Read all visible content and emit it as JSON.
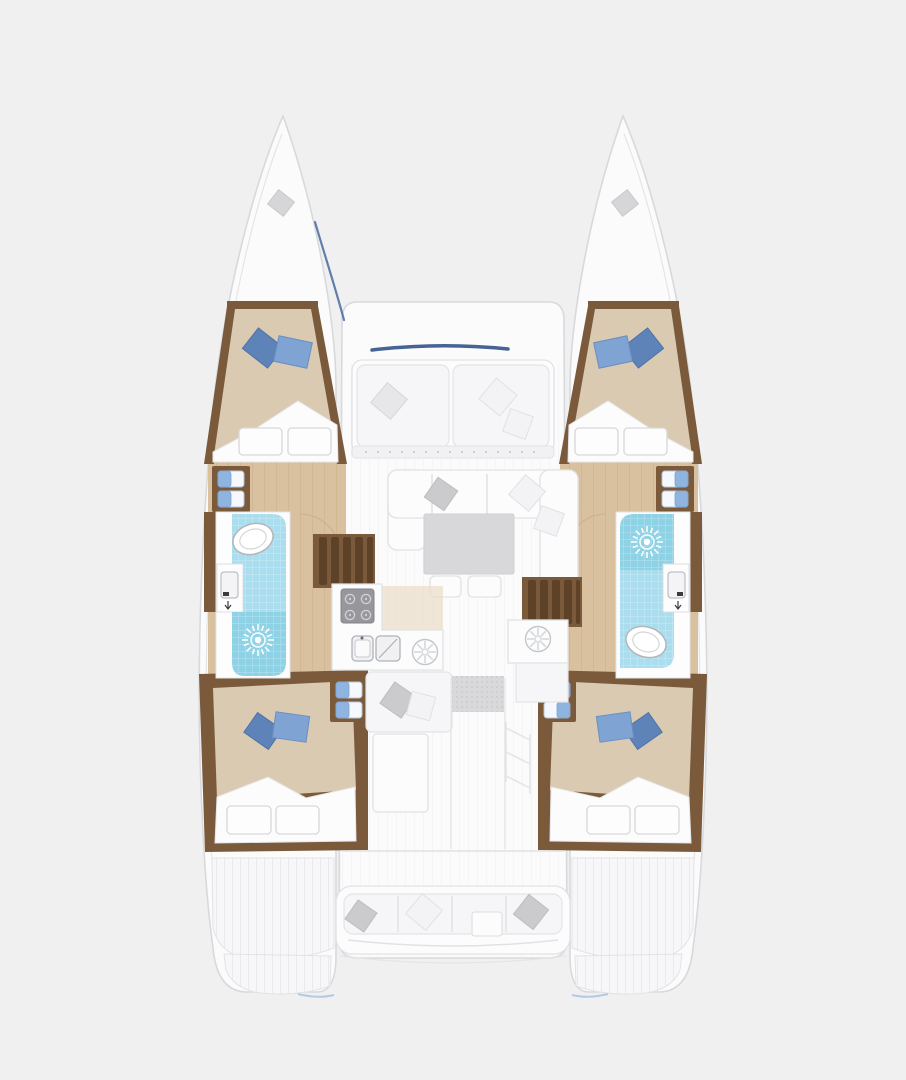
{
  "page": {
    "type": "catamaran-deck-floor-plan",
    "view": "top-down",
    "background": "#f0f0f1"
  },
  "palette": {
    "bg": "#f0f0f1",
    "hull": "#fbfbfc",
    "hullStroke": "#d7d9dc",
    "trim": "#7a5a3a",
    "trimDark": "#5d4227",
    "wood": "#d9c09f",
    "plankLine": "#c9ac89",
    "bedTan": "#d9cab1",
    "pillowBlue": "#5e83b8",
    "pillowBlueLight": "#7fa3d3",
    "headTile": "#aadeee",
    "showerBlue": "#8ed2e6",
    "stepBlue": "#8fb4e0",
    "furnGray": "#d8d8da",
    "windshieldNavy": "#35568a",
    "halyardBlue": "#49699f"
  },
  "vessel": {
    "hulls": 2,
    "cabins": [
      {
        "id": "port-forward-cabin",
        "berth": "double",
        "blue_pillows": 2,
        "foot_cushions": 2
      },
      {
        "id": "starboard-forward-cabin",
        "berth": "double",
        "blue_pillows": 2,
        "foot_cushions": 2
      },
      {
        "id": "port-aft-cabin",
        "berth": "double",
        "blue_pillows": 2,
        "foot_cushions": 2
      },
      {
        "id": "starboard-aft-cabin",
        "berth": "double",
        "blue_pillows": 2,
        "foot_cushions": 2
      }
    ],
    "heads": [
      {
        "id": "port-head",
        "order_fore_to_aft": [
          "toilet",
          "sink",
          "shower"
        ]
      },
      {
        "id": "starboard-head",
        "order_fore_to_aft": [
          "shower",
          "sink",
          "toilet"
        ]
      }
    ],
    "galley": {
      "stove_burners": 4,
      "sinks": 2,
      "round_hatches": 2
    },
    "salon": {
      "sofa": "U-shaped",
      "table": 1,
      "ottomans": 2,
      "forward_lounge_cushions": 2
    },
    "companionway_stairs": 2,
    "entry_mat": 1,
    "cockpit": {
      "bench": 1,
      "pillows": 3,
      "side_table": 1
    },
    "transoms": {
      "swim_platforms": 2
    }
  }
}
